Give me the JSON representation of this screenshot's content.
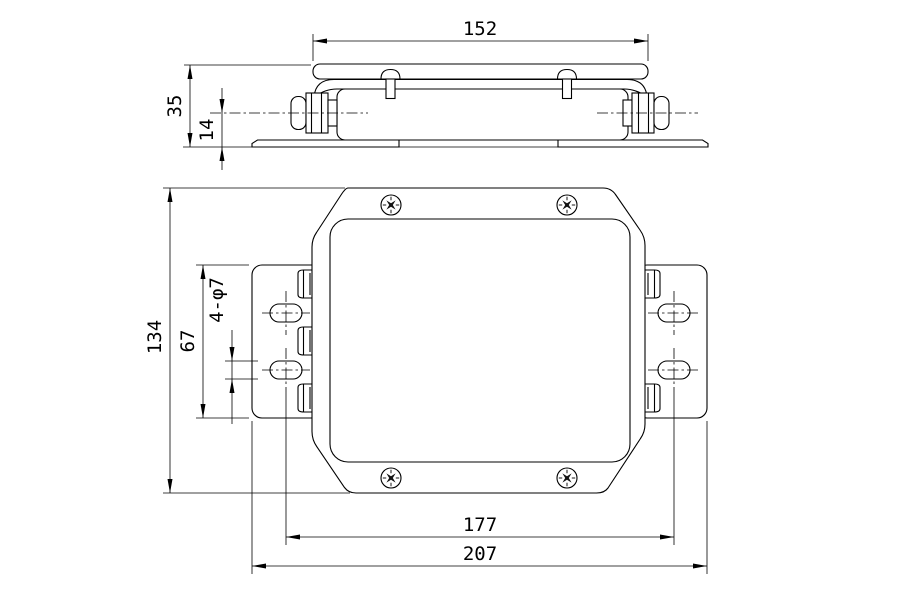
{
  "drawing": {
    "dims": {
      "cover_width": "152",
      "body_height": "35",
      "gland_center_height": "14",
      "overall_depth": "134",
      "bracket_height": "67",
      "mounting_holes": "4-φ7",
      "hole_spacing": "177",
      "overall_width": "207"
    }
  }
}
